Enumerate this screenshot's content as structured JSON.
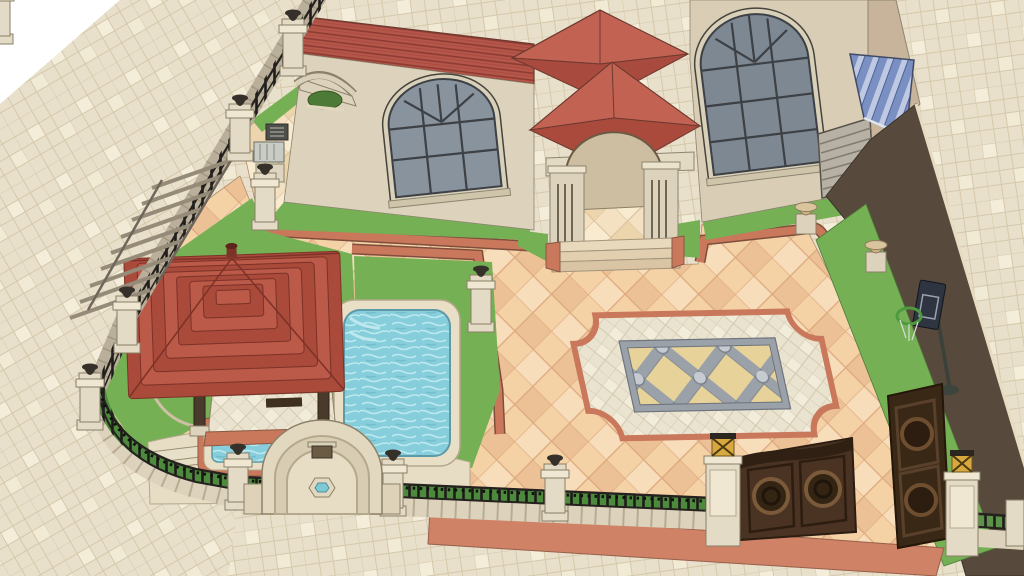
{
  "scene": {
    "type": "3d-architectural-exterior-render",
    "style": "sketchup-like line-and-fill rendering, aerial three-quarter view",
    "subject": "villa courtyard with swimming pool, gazebo, entrance gate and garage ramp",
    "objects": [
      {
        "id": "villa-house",
        "desc": "cream stucco house with red tile roofs, upper left"
      },
      {
        "id": "arched-window-left",
        "desc": "arched multi-pane window, grey glass"
      },
      {
        "id": "arched-window-right",
        "desc": "tall arched multi-pane window, grey glass"
      },
      {
        "id": "entry-porch",
        "desc": "porch with pyramidal red tile roof, grooved pillars, arch and steps"
      },
      {
        "id": "bay-pyramid-roof",
        "desc": "small pyramidal roof over bay, top centre"
      },
      {
        "id": "gazebo",
        "desc": "large pyramidal red tile gazebo roof over tiled floor, lower left"
      },
      {
        "id": "swimming-pool",
        "desc": "rectangular pool, rounded corners, light blue water"
      },
      {
        "id": "jacuzzi",
        "desc": "small plunge pool beside gazebo"
      },
      {
        "id": "wall-fountain",
        "desc": "arched wall fountain with hexagonal basin on the street wall"
      },
      {
        "id": "courtyard-medallion",
        "desc": "decorative paving medallion: pink scalloped border, cream field, grey lattice inlay with circles"
      },
      {
        "id": "perimeter-fence",
        "desc": "stone base wall with black iron railing and pillars topped by dark urns"
      },
      {
        "id": "pergola",
        "desc": "slatted lean structure on the left fence"
      },
      {
        "id": "ac-units",
        "desc": "outdoor AC units and utility cabinet on upper-left patio"
      },
      {
        "id": "planter-urns",
        "desc": "tan planter urns on pedestals at walkway corners"
      },
      {
        "id": "main-gate",
        "desc": "dark brown ornamental double gate, one leaf open, gold lantern pillars"
      },
      {
        "id": "garage-ramp",
        "desc": "dark driveway ramp to garage with louvered door and blue striped awning"
      },
      {
        "id": "basketball-hoop",
        "desc": "portable basketball hoop on lawn strip beside ramp"
      },
      {
        "id": "sidewalk",
        "desc": "beige tiled public sidewalk around the plot"
      }
    ]
  },
  "palette": {
    "paper": "#ffffff",
    "sidewalk": "#e9e0cb",
    "sidewalk_line": "#d5c8ab",
    "court": "#f5d2a6",
    "court_line": "#dca87e",
    "band": "#c9785c",
    "grass": "#76b055",
    "grass_dark": "#5f9a43",
    "water": "#86cedb",
    "roof": "#b0493c",
    "roof_dark": "#8e3c32",
    "roof_light": "#c26253",
    "wall": "#ddd2bb",
    "wall_dark": "#c8b49a",
    "stone": "#e7ddc5",
    "glass": "#89939d",
    "frame": "#3d4045",
    "iron": "#24211e",
    "gate": "#4a3322",
    "ramp": "#57493c",
    "awning": "#7b90c2",
    "gold": "#d8a83e",
    "med_gray": "#9aa1a9",
    "med_gold": "#e7d399",
    "med_cream": "#eae3d0"
  }
}
